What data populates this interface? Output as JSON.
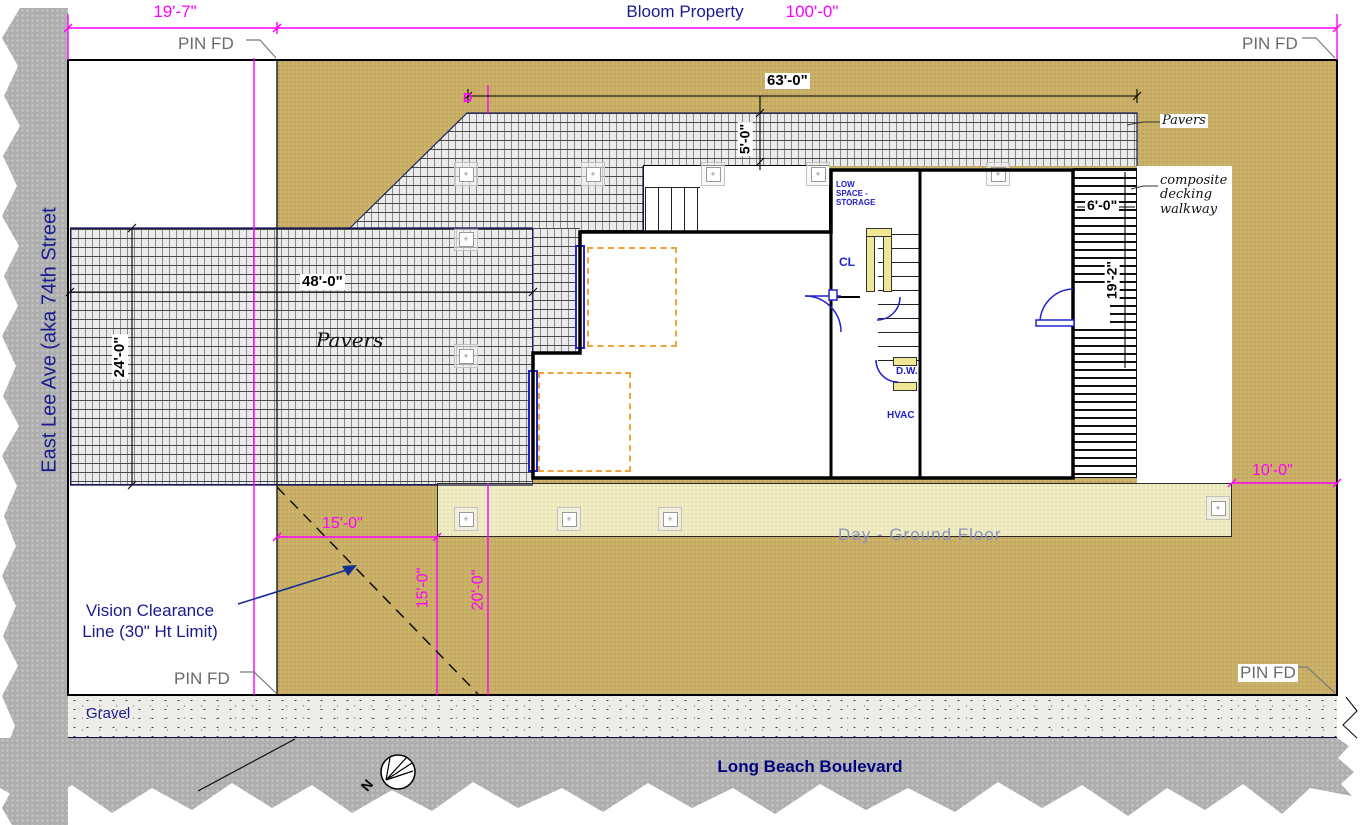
{
  "top": {
    "dim_left": "19'-7\"",
    "property_label": "Bloom Property",
    "dim_total": "100'-0\"",
    "pin_fd": "PIN FD"
  },
  "streets": {
    "left": "East Lee Ave (aka 74th Street",
    "bottom": "Long Beach Boulevard"
  },
  "labels": {
    "pavers_large": "Pavers",
    "pavers_small": "Pavers",
    "walkway": "composite decking walkway",
    "gravel": "Gravel",
    "vision_line1": "Vision Clearance",
    "vision_line2": "Line (30\" Ht Limit)",
    "ground_floor": "Day - Ground Floor",
    "low_space": "LOW SPACE - STORAGE",
    "closet": "CL",
    "dishwasher": "D.W.",
    "hvac": "HVAC",
    "north": "N",
    "d_marker": "D"
  },
  "dimensions": {
    "front_pavers_w": "48'-0\"",
    "front_pavers_h": "24'-0\"",
    "rear_pavers_w": "63'-0\"",
    "rear_pavers_h": "5'-0\"",
    "walkway_w": "6'-0\"",
    "walkway_h": "19'-2\"",
    "vision_w": "15'-0\"",
    "vision_h": "15'-0\"",
    "side_h": "20'-0\"",
    "rear_side_w": "10'-0\""
  },
  "glyphs": {
    "plus": "+"
  },
  "colors": {
    "magenta": "#FF00FF",
    "navy": "#1A1A8F",
    "plan_blue": "#2020CC",
    "olive": "#C9B465",
    "cream": "#F0EDC4",
    "street_gray": "#AEAEAE",
    "orange_dash": "#F2A43C",
    "yellow_wall": "#EFE794",
    "faint_label": "#8A93BB"
  }
}
